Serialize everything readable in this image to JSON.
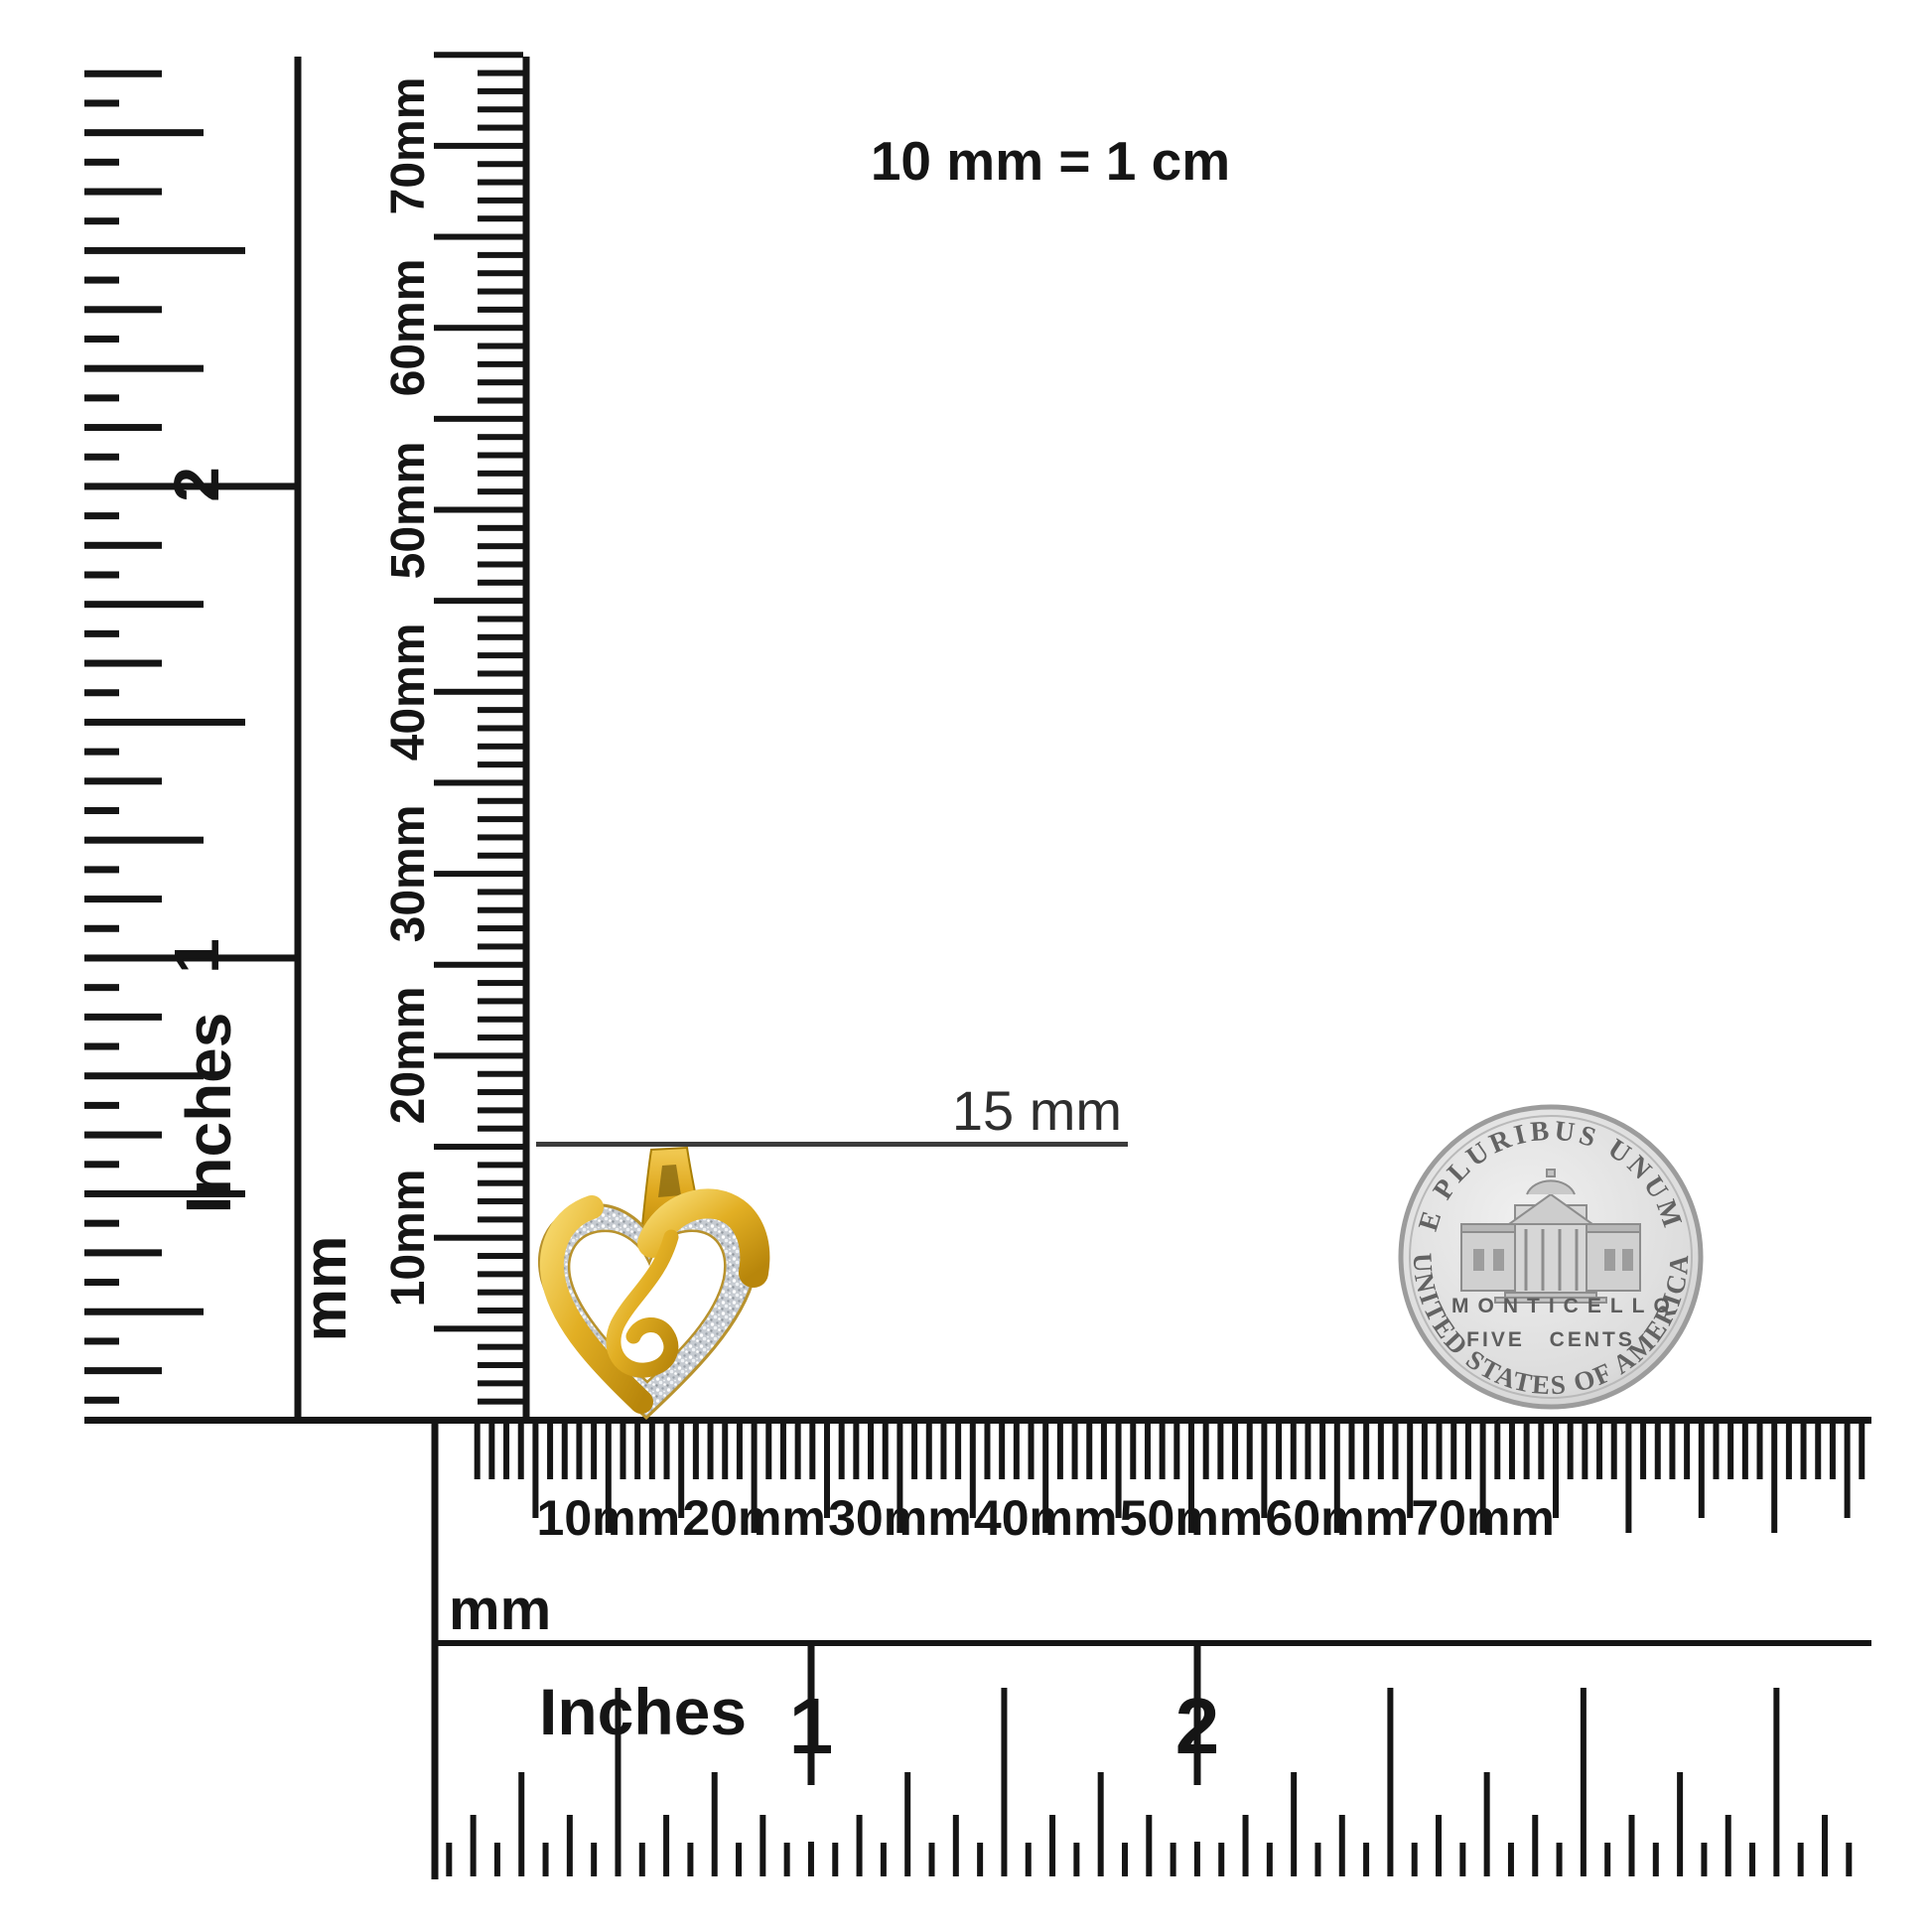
{
  "title": "10 mm = 1 cm",
  "annotation": {
    "label": "15 mm"
  },
  "vertical_inch_ruler": {
    "unit_label": "Inches",
    "numbers": [
      "1",
      "2"
    ]
  },
  "vertical_mm_ruler": {
    "unit_label": "mm",
    "tick_labels": [
      "10mm",
      "20mm",
      "30mm",
      "40mm",
      "50mm",
      "60mm",
      "70mm"
    ]
  },
  "bottom_mm_ruler": {
    "unit_label": "mm",
    "tick_labels": [
      "10mm",
      "20mm",
      "30mm",
      "40mm",
      "50mm",
      "60mm",
      "70mm"
    ]
  },
  "bottom_inch_ruler": {
    "unit_label": "Inches",
    "numbers": [
      "1",
      "2"
    ]
  },
  "coin": {
    "top_legend": "E PLURIBUS UNUM",
    "building_label": "MONTICELLO",
    "denomination": "FIVE CENTS",
    "bottom_legend": "UNITED STATES OF AMERICA"
  },
  "colors": {
    "ink": "#151515",
    "annotation_line": "#3c3c3c",
    "gold": "#e2af24",
    "gold_light": "#f7d96e",
    "gold_dark": "#a97f06",
    "pave_silver": "#c6cbd1",
    "coin_silver": "#d8d8d8",
    "coin_detail": "#8d8d8d"
  }
}
